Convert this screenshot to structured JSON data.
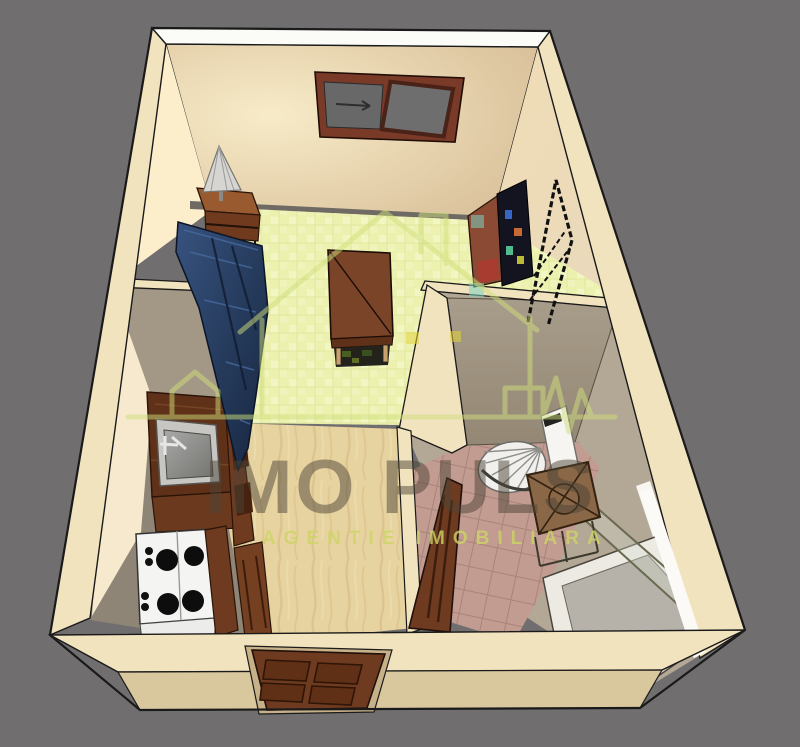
{
  "image": {
    "kind": "3d-apartment-floorplan-render",
    "width": 800,
    "height": 747
  },
  "watermark": {
    "title": "IMO PULS",
    "subtitle": "AGENTIE IMOBILIARA",
    "logo": "house-pulse-logo",
    "title_color": "#4b4336",
    "subtitle_color": "#cdd465",
    "logo_color": "#cfdf7b",
    "square_teal": "#7dd1bf",
    "square_yellow": "#e3d33c"
  },
  "palette": {
    "background": "#706e6f",
    "wall_cream": "#f2e3bf",
    "wall_top_white": "#fbfbf8",
    "wall_front_face": "#d9c79e",
    "partition_gray": "#a39785",
    "carpet": "#edf1af",
    "wood_floor": "#e7d3a0",
    "bath_tile": "#c29b91",
    "sofa_blue": "#2c4673",
    "table_wood": "#7a4428",
    "counter_wood": "#5f3118",
    "stove_white": "#f4f4f2",
    "door_brown": "#6e3b20",
    "window_frame": "#7a3a28",
    "window_glass": "#686868",
    "tv_dark": "#141420",
    "fixture_white": "#f6f5f2",
    "box_brown": "#8a6747",
    "outline": "#1a1a1a"
  },
  "scene": {
    "rooms": [
      "living-room",
      "kitchen",
      "hallway",
      "bathroom"
    ],
    "furniture": [
      "sliding-window",
      "table-lamp",
      "nightstand",
      "sofa",
      "coffee-table",
      "tv-cabinet",
      "drying-rack",
      "kitchen-sink",
      "stove",
      "kitchen-cabinets",
      "corner-sink",
      "toilet",
      "storage-box",
      "shower-screen",
      "bathtub",
      "bathroom-door",
      "entry-door"
    ]
  }
}
